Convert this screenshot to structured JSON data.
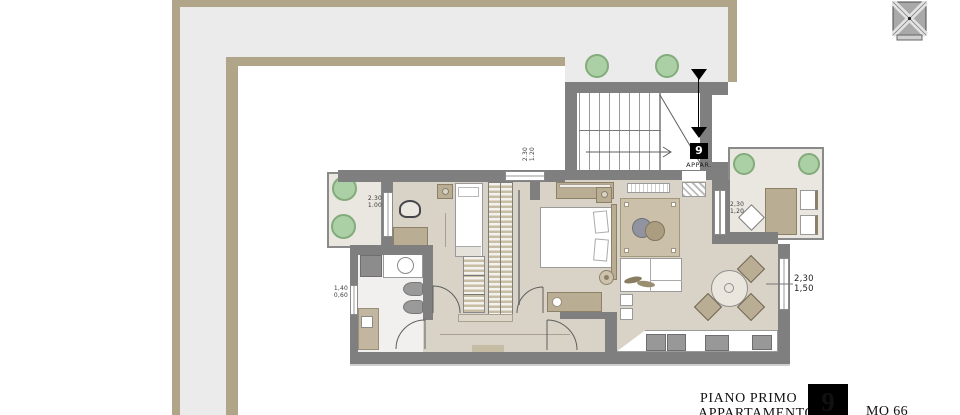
{
  "title_block": {
    "floor_label": "PIANO PRIMO",
    "unit_label": "APPARTAMENTO",
    "unit_number": "9",
    "area_label": "MQ 66"
  },
  "stairwell": {
    "unit_number": "9",
    "caption": "APPAR."
  },
  "dimensions": {
    "balcony_window": {
      "line1": "2.30",
      "line2": "1.00"
    },
    "entry_window": {
      "line1": "2.30",
      "line2": "1.20"
    },
    "bath_window": {
      "line1": "1,40",
      "line2": "0,60"
    },
    "terrace_window": {
      "line1": "2,30",
      "line2": "1,20"
    },
    "dining_window": {
      "line1": "2,30",
      "line2": "1,50"
    }
  },
  "colors": {
    "roof_band_edge": "#b0a489",
    "roof_band_fill": "#ebebec",
    "wall": "#7f7f7f",
    "floor": "#d8d3c6",
    "outdoor_floor": "#e9e7e0",
    "furniture_tan": "#b9ad94",
    "plant_green": "#abd0a5",
    "annotation_black": "#000000"
  }
}
